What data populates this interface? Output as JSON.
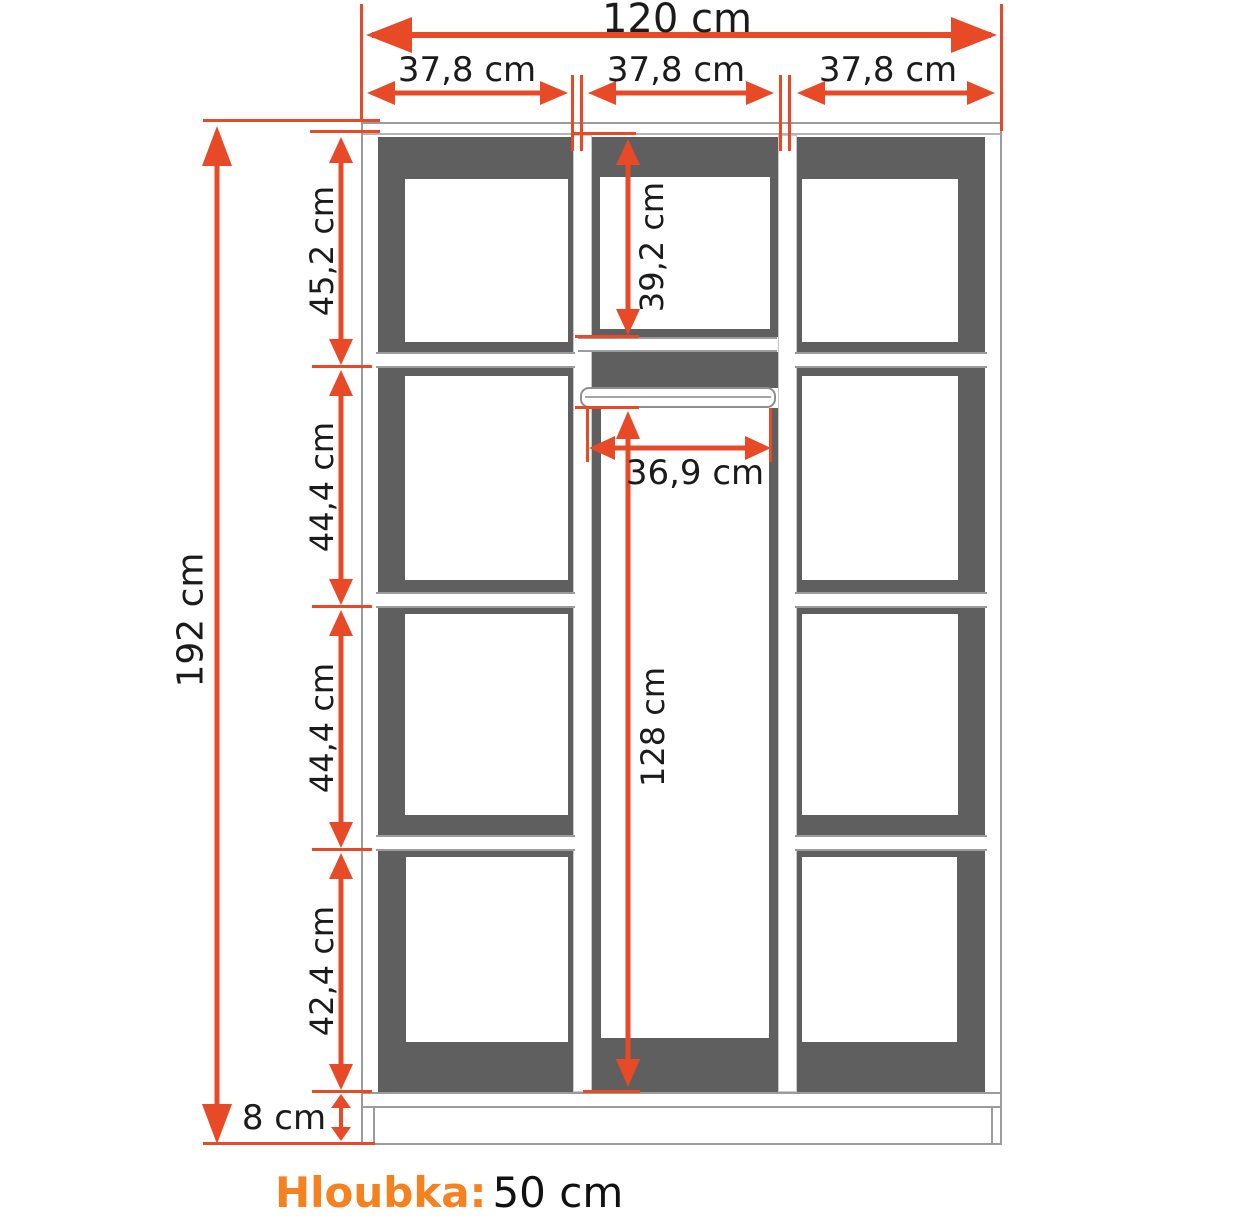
{
  "diagram": {
    "kind": "wardrobe-dimension-drawing",
    "colors": {
      "dimension_arrows": "#E84A27",
      "depth_label_accent": "#F5821F",
      "interior_shade": "#5F5F5F",
      "outline": "#9C9C9C",
      "text": "#1B1B1B"
    },
    "overall": {
      "width": "120 cm",
      "height": "192 cm",
      "plinth": "8 cm"
    },
    "sections": {
      "left": "37,8 cm",
      "middle": "37,8 cm",
      "right": "37,8 cm"
    },
    "left_column_rows": [
      "45,2 cm",
      "44,4 cm",
      "44,4 cm",
      "42,4 cm"
    ],
    "middle_column": {
      "top_compartment": "39,2 cm",
      "rail_width": "36,9 cm",
      "hanging_height": "128 cm"
    },
    "depth": {
      "label": "Hloubka:",
      "value": "50 cm"
    }
  }
}
